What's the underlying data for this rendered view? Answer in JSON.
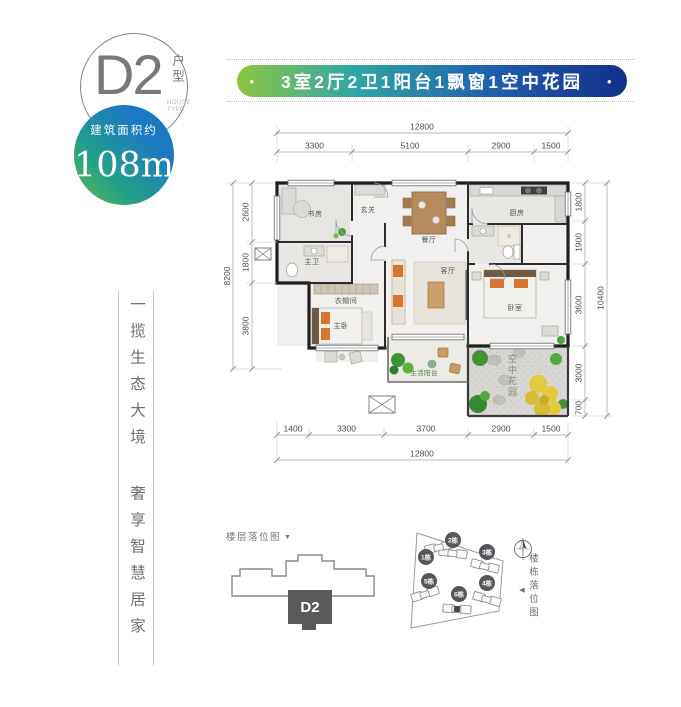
{
  "logo": {
    "unit": "D2",
    "unit_type": "户型",
    "unit_type_en_line1": "HOUSE",
    "unit_type_en_line2": "TYPE",
    "area_label": "建筑面积约",
    "area_value": "108m",
    "area_sup": "2"
  },
  "banner": {
    "bullet": "•",
    "text": "3室2厅2卫1阳台1飘窗1空中花园",
    "gradient_start": "#8dc63f",
    "gradient_end": "#142f89"
  },
  "slogan": {
    "part1": "一揽生态大境",
    "part2": "奢享智慧居家"
  },
  "plan": {
    "rooms": {
      "study": "书房",
      "foyer": "玄关",
      "dining": "餐厅",
      "kitchen": "厨房",
      "master_bath": "主卫",
      "cloakroom": "衣帽间",
      "master_bedroom": "主卧",
      "living": "客厅",
      "bedroom": "卧室",
      "balcony": "生活阳台",
      "sky_garden": "空中花园"
    },
    "dims": {
      "top_total": "12800",
      "top_segments": [
        "3300",
        "5100",
        "2900",
        "1500"
      ],
      "bottom_segments": [
        "1400",
        "3300",
        "3700",
        "2900",
        "1500"
      ],
      "bottom_total": "12800",
      "left_total": "8200",
      "left_segments": [
        "2600",
        "1800",
        "3800"
      ],
      "right_segments": [
        "1800",
        "1900",
        "3600",
        "3000",
        "700"
      ],
      "right_total": "10400"
    }
  },
  "floor_diagram": {
    "title": "楼层落位图",
    "arrow": "▼",
    "unit_label": "D2"
  },
  "site_diagram": {
    "title": "楼栋落位图",
    "arrow": "◀",
    "buildings": [
      "1栋",
      "2栋",
      "3栋",
      "4栋",
      "5栋",
      "6栋"
    ]
  }
}
